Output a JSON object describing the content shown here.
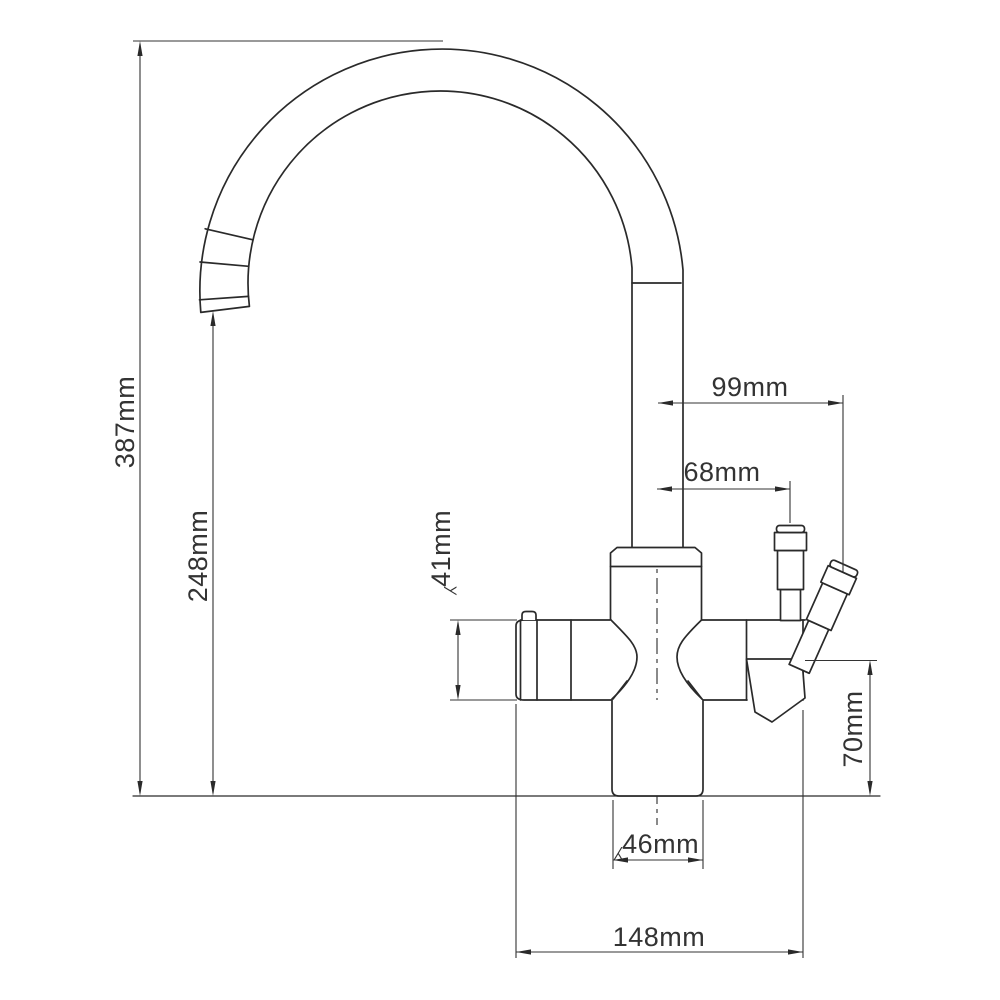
{
  "drawing": {
    "background": "#ffffff",
    "line_color": "#2a2a2a",
    "dimension_color": "#333333",
    "dimensions": {
      "overall_height": "387mm",
      "spout_outlet_height": "248mm",
      "spout_offset_right": "99mm",
      "handle_offset_right": "68mm",
      "handle_diameter": "⁁41mm",
      "lever_bottom_height": "70mm",
      "base_diameter": "⁁46mm",
      "overall_depth": "148mm"
    }
  }
}
